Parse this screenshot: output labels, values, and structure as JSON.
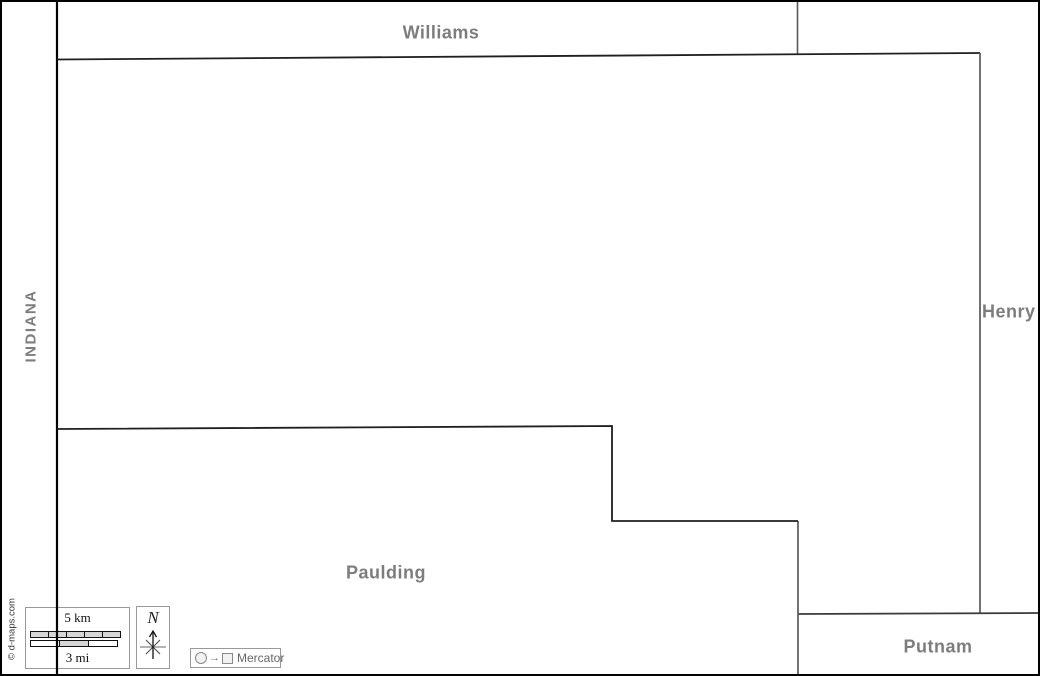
{
  "map": {
    "state_border_label": "INDIANA",
    "neighbor_labels": {
      "north": "Williams",
      "east": "Henry",
      "southwest": "Paulding",
      "southeast": "Putnam"
    }
  },
  "scale_bar": {
    "km_label": "5 km",
    "mi_label": "3 mi"
  },
  "compass": {
    "north_label": "N"
  },
  "projection_legend": {
    "arrow": "→",
    "label": "Mercator"
  },
  "credit": "© d-maps.com",
  "colors": {
    "label_gray": "#7d7d7d",
    "state_line": "#000000",
    "county_line_dark": "#1f1f1f",
    "county_line_gray": "#5a5a5a",
    "scale_segment_fill": "#d6d6d6",
    "frame_border": "#000000"
  }
}
